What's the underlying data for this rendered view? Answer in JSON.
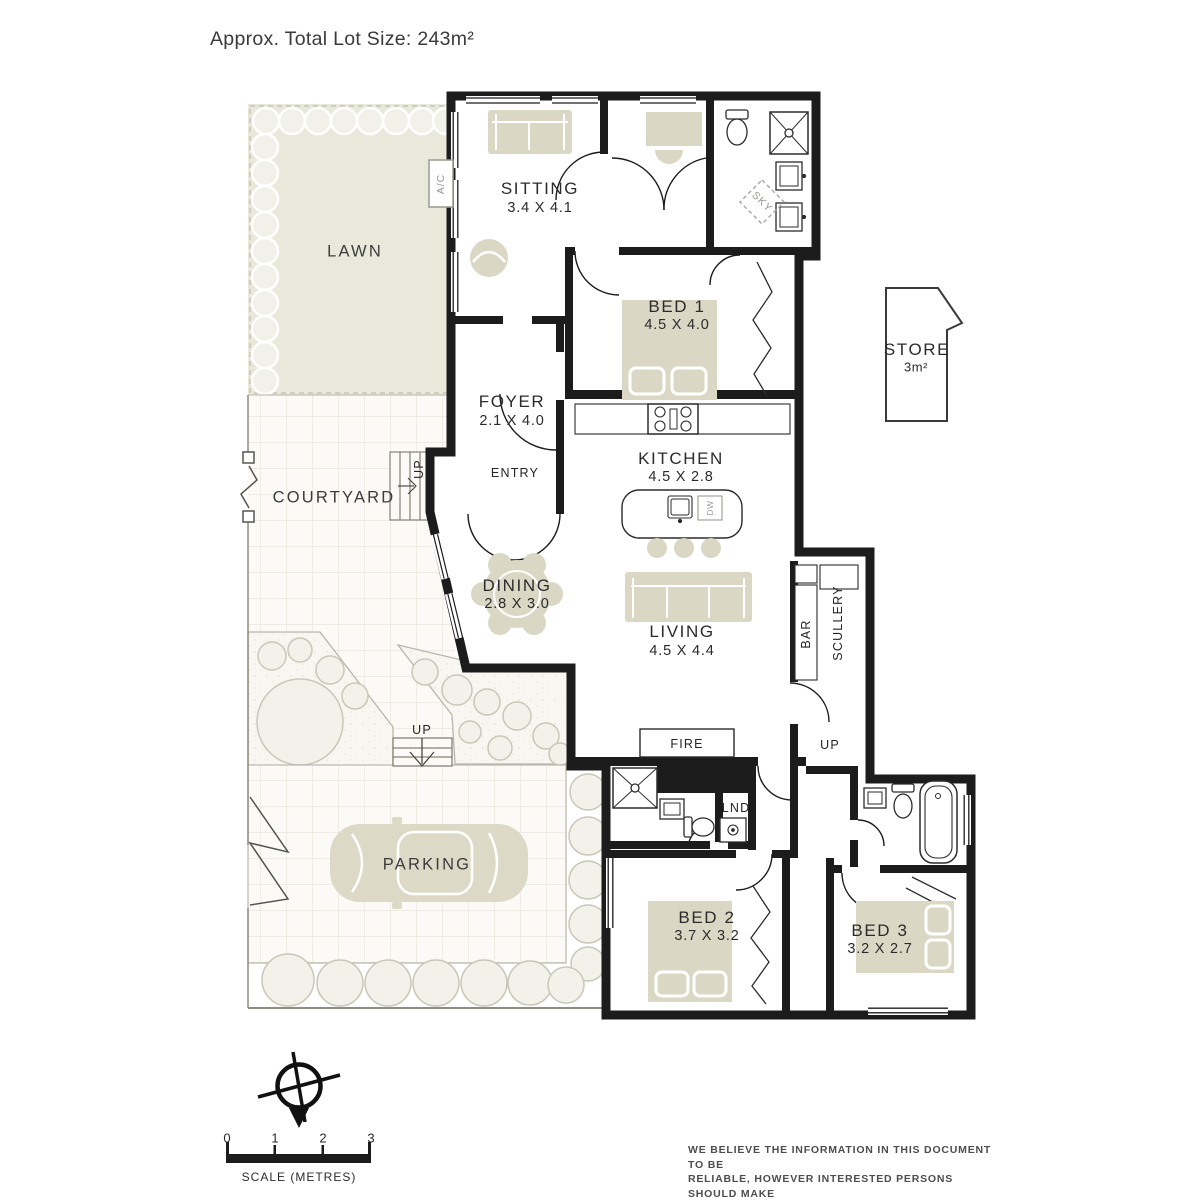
{
  "title": "Approx. Total Lot Size: 243m²",
  "areas": {
    "lawn": {
      "name": "LAWN"
    },
    "courtyard": {
      "name": "COURTYARD"
    },
    "parking": {
      "name": "PARKING"
    },
    "sitting": {
      "name": "SITTING",
      "dims": "3.4 X 4.1"
    },
    "foyer": {
      "name": "FOYER",
      "dims": "2.1 X 4.0"
    },
    "bed1": {
      "name": "BED 1",
      "dims": "4.5 X 4.0"
    },
    "kitchen": {
      "name": "KITCHEN",
      "dims": "4.5 X 2.8"
    },
    "dining": {
      "name": "DINING",
      "dims": "2.8 X 3.0"
    },
    "living": {
      "name": "LIVING",
      "dims": "4.5 X 4.4"
    },
    "bed2": {
      "name": "BED 2",
      "dims": "3.7 X 3.2"
    },
    "bed3": {
      "name": "BED 3",
      "dims": "3.2 X 2.7"
    },
    "store": {
      "name": "STORE",
      "dims": "3m²"
    }
  },
  "labels": {
    "entry": "ENTRY",
    "fire": "FIRE",
    "bar": "BAR",
    "scullery": "SCULLERY",
    "lnd": "LND",
    "ac": "A/C",
    "sky": "SKY",
    "dw": "DW",
    "up": "UP"
  },
  "scale": {
    "ticks": [
      "0",
      "1",
      "2",
      "3"
    ],
    "label": "SCALE (METRES)"
  },
  "disclaimer": {
    "lines": [
      "WE BELIEVE THE INFORMATION IN THIS DOCUMENT TO BE",
      "RELIABLE, HOWEVER INTERESTED PERSONS SHOULD MAKE",
      "THEIR OWN ENQUIRIES. DIMENSIONS ARE APPROXIMATE."
    ]
  },
  "colors": {
    "wall": "#1c1c1c",
    "furniture": "#dad8c5",
    "lawn": "#e8e9da",
    "paving_tile": "#fbfaf6",
    "tile_line": "#e8e6de",
    "shrub": "#f1f0e9",
    "label_text": "#2b2b2b",
    "muted_text": "#97978e"
  }
}
